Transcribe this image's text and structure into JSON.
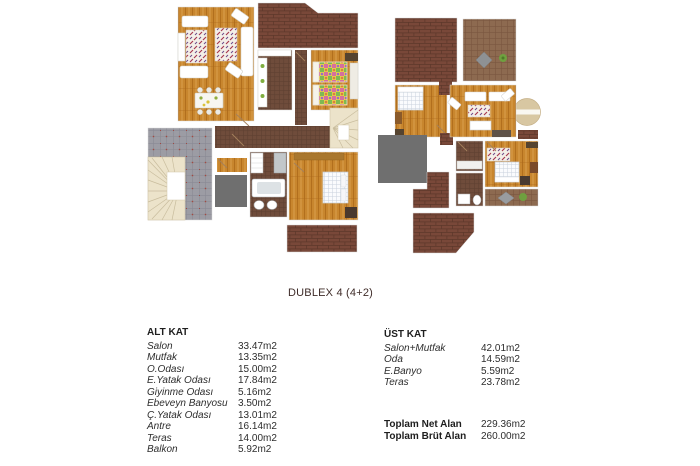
{
  "title": "DUBLEX 4 (4+2)",
  "tables": {
    "alt_kat": {
      "header": "ALT KAT",
      "rows": [
        {
          "label": "Salon",
          "value": "33.47m2"
        },
        {
          "label": "Mutfak",
          "value": "13.35m2"
        },
        {
          "label": "O.Odası",
          "value": "15.00m2"
        },
        {
          "label": "E.Yatak Odası",
          "value": "17.84m2"
        },
        {
          "label": "Giyinme Odası",
          "value": "5.16m2"
        },
        {
          "label": "Ebeveyn Banyosu",
          "value": "3.50m2"
        },
        {
          "label": "Ç.Yatak Odası",
          "value": "13.01m2"
        },
        {
          "label": "Antre",
          "value": "16.14m2"
        },
        {
          "label": "Teras",
          "value": "14.00m2"
        },
        {
          "label": "Balkon",
          "value": "5.92m2"
        }
      ]
    },
    "ust_kat": {
      "header": "ÜST KAT",
      "rows": [
        {
          "label": "Salon+Mutfak",
          "value": "42.01m2"
        },
        {
          "label": "Oda",
          "value": "14.59m2"
        },
        {
          "label": "E.Banyo",
          "value": "5.59m2"
        },
        {
          "label": "Teras",
          "value": "23.78m2"
        }
      ]
    },
    "totals": {
      "rows": [
        {
          "label": "Toplam Net Alan",
          "value": "229.36m2"
        },
        {
          "label": "Toplam Brüt Alan",
          "value": "260.00m2"
        }
      ]
    }
  },
  "colors": {
    "wood_floor": "#c8862e",
    "brick_terrace": "#794839",
    "terrace_grid": "#8d6a50",
    "dark_tile_floor": "#6f4c3b",
    "gray_tile_terrace": "#9c9ca4",
    "elevator_gray": "#6f6f6f",
    "stair_cream": "#ece3ca",
    "title_text": "#3f2c29",
    "body_text": "#2d2d2d"
  }
}
